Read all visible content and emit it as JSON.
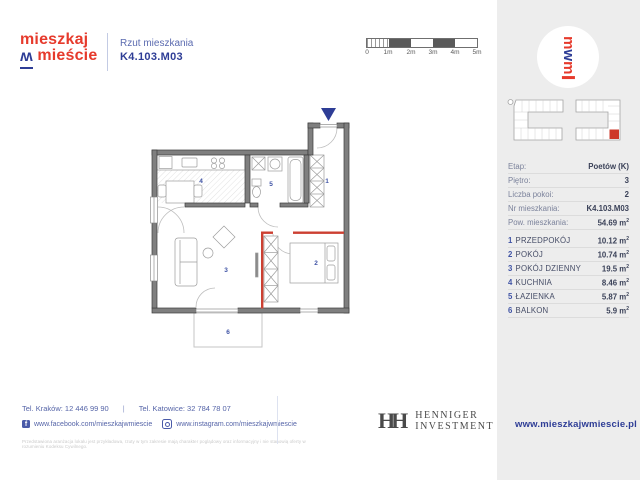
{
  "brand": {
    "word1": "mieszkaj",
    "word2": "w",
    "word3": "mieście"
  },
  "header": {
    "doc_type": "Rzut mieszkania",
    "unit_code": "K4.103.M03"
  },
  "scalebar": {
    "labels": [
      "0",
      "1m",
      "2m",
      "3m",
      "4m",
      "5m"
    ]
  },
  "monogram": {
    "letter1": "m",
    "letter2": "w",
    "letter3": "m"
  },
  "sidebar": {
    "details": [
      {
        "label": "Etap:",
        "value": "Poetów (K)"
      },
      {
        "label": "Piętro:",
        "value": "3"
      },
      {
        "label": "Liczba pokoi:",
        "value": "2"
      },
      {
        "label": "Nr mieszkania:",
        "value": "K4.103.M03"
      },
      {
        "label": "Pow. mieszkania:",
        "value": "54.69"
      }
    ],
    "area_unit": {
      "base": "m",
      "sup": "2"
    },
    "rooms": [
      {
        "no": "1",
        "name": "PRZEDPOKÓJ",
        "area": "10.12"
      },
      {
        "no": "2",
        "name": "POKÓJ",
        "area": "10.74"
      },
      {
        "no": "3",
        "name": "POKÓJ DZIENNY",
        "area": "19.5"
      },
      {
        "no": "4",
        "name": "KUCHNIA",
        "area": "8.46"
      },
      {
        "no": "5",
        "name": "ŁAZIENKA",
        "area": "5.87"
      },
      {
        "no": "6",
        "name": "BALKON",
        "area": "5.9"
      }
    ],
    "website": "www.mieszkajwmiescie.pl"
  },
  "plan": {
    "labels": {
      "r1": "1",
      "r2": "2",
      "r3": "3",
      "r4": "4",
      "r5": "5",
      "r6": "6"
    }
  },
  "footer": {
    "tel_krakow": "Tel. Kraków: 12 446 99 90",
    "separator": "|",
    "tel_katowice": "Tel. Katowice: 32 784 78 07",
    "facebook_url": "www.facebook.com/mieszkajwmiescie",
    "facebook_icon_letter": "f",
    "instagram_url": "www.instagram.com/mieszkajwmiescie",
    "disclaimer": "Przedstawiona aranżacja lokalu jest przykładowa, rzuty w tym zakresie mają charakter poglądowy oraz informacyjny i nie stanowią oferty w rozumieniu Kodeksu Cywilnego.",
    "developer_monogram": "HH",
    "developer_line1": "HENNIGER",
    "developer_line2": "INVESTMENT"
  },
  "colors": {
    "brand_red": "#e63a2c",
    "brand_blue": "#2e3d96",
    "panel_bg": "#ededed",
    "wall_gray": "#7f7f7f",
    "accent_red_wall": "#cc4032",
    "site_unit_red": "#cd3728"
  }
}
